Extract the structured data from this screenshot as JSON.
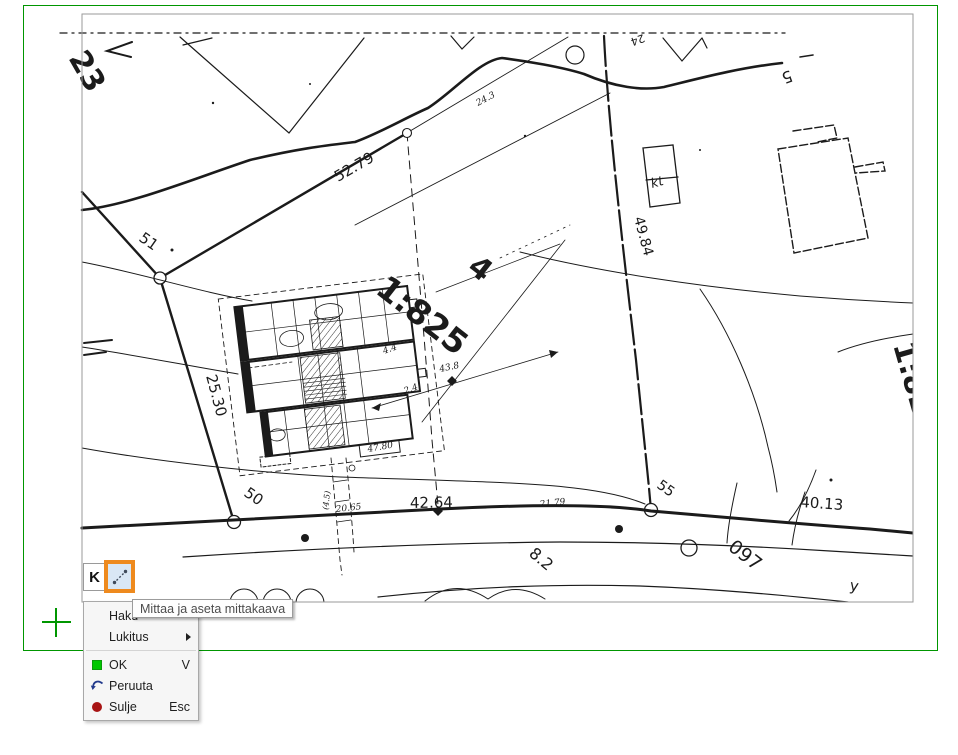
{
  "colors": {
    "frame_green": "#009600",
    "viewport_border_gray": "#9a9a9a",
    "highlight_orange": "#ee8a1e",
    "ok_icon_green": "#00c800",
    "close_icon_red": "#a81414",
    "undo_icon_blue": "#223a8c",
    "map_ink": "#1b1b1b",
    "tooltip_bg": "#fefefe",
    "menu_bg": "#f6f6f6"
  },
  "toolbar": {
    "k_button_label": "K",
    "measure_tooltip": "Mittaa ja aseta mittakaava"
  },
  "context_menu": {
    "items": [
      {
        "label": "Haku",
        "shortcut": ""
      },
      {
        "label": "Lukitus",
        "shortcut": "",
        "has_submenu": true
      },
      {
        "label": "OK",
        "shortcut": "V",
        "icon": "green-square"
      },
      {
        "label": "Peruuta",
        "shortcut": "",
        "icon": "undo-arrow"
      },
      {
        "label": "Sulje",
        "shortcut": "Esc",
        "icon": "red-circle"
      }
    ]
  },
  "map": {
    "plot_ratio_label": "1:825",
    "labels": [
      {
        "text": "23"
      },
      {
        "text": "24.3"
      },
      {
        "text": "24"
      },
      {
        "text": "5"
      },
      {
        "text": "51"
      },
      {
        "text": "52.79"
      },
      {
        "text": "49.84"
      },
      {
        "text": "kt"
      },
      {
        "text": "4"
      },
      {
        "text": "1:825"
      },
      {
        "text": "1:82"
      },
      {
        "text": "4.4"
      },
      {
        "text": "43.8"
      },
      {
        "text": "2.4"
      },
      {
        "text": "25.30"
      },
      {
        "text": "50"
      },
      {
        "text": "47.80"
      },
      {
        "text": "(4.5)"
      },
      {
        "text": "20.65"
      },
      {
        "text": "42.64"
      },
      {
        "text": "21.79"
      },
      {
        "text": "8.2"
      },
      {
        "text": "55"
      },
      {
        "text": "097"
      },
      {
        "text": "40.13"
      },
      {
        "text": "y"
      }
    ]
  }
}
